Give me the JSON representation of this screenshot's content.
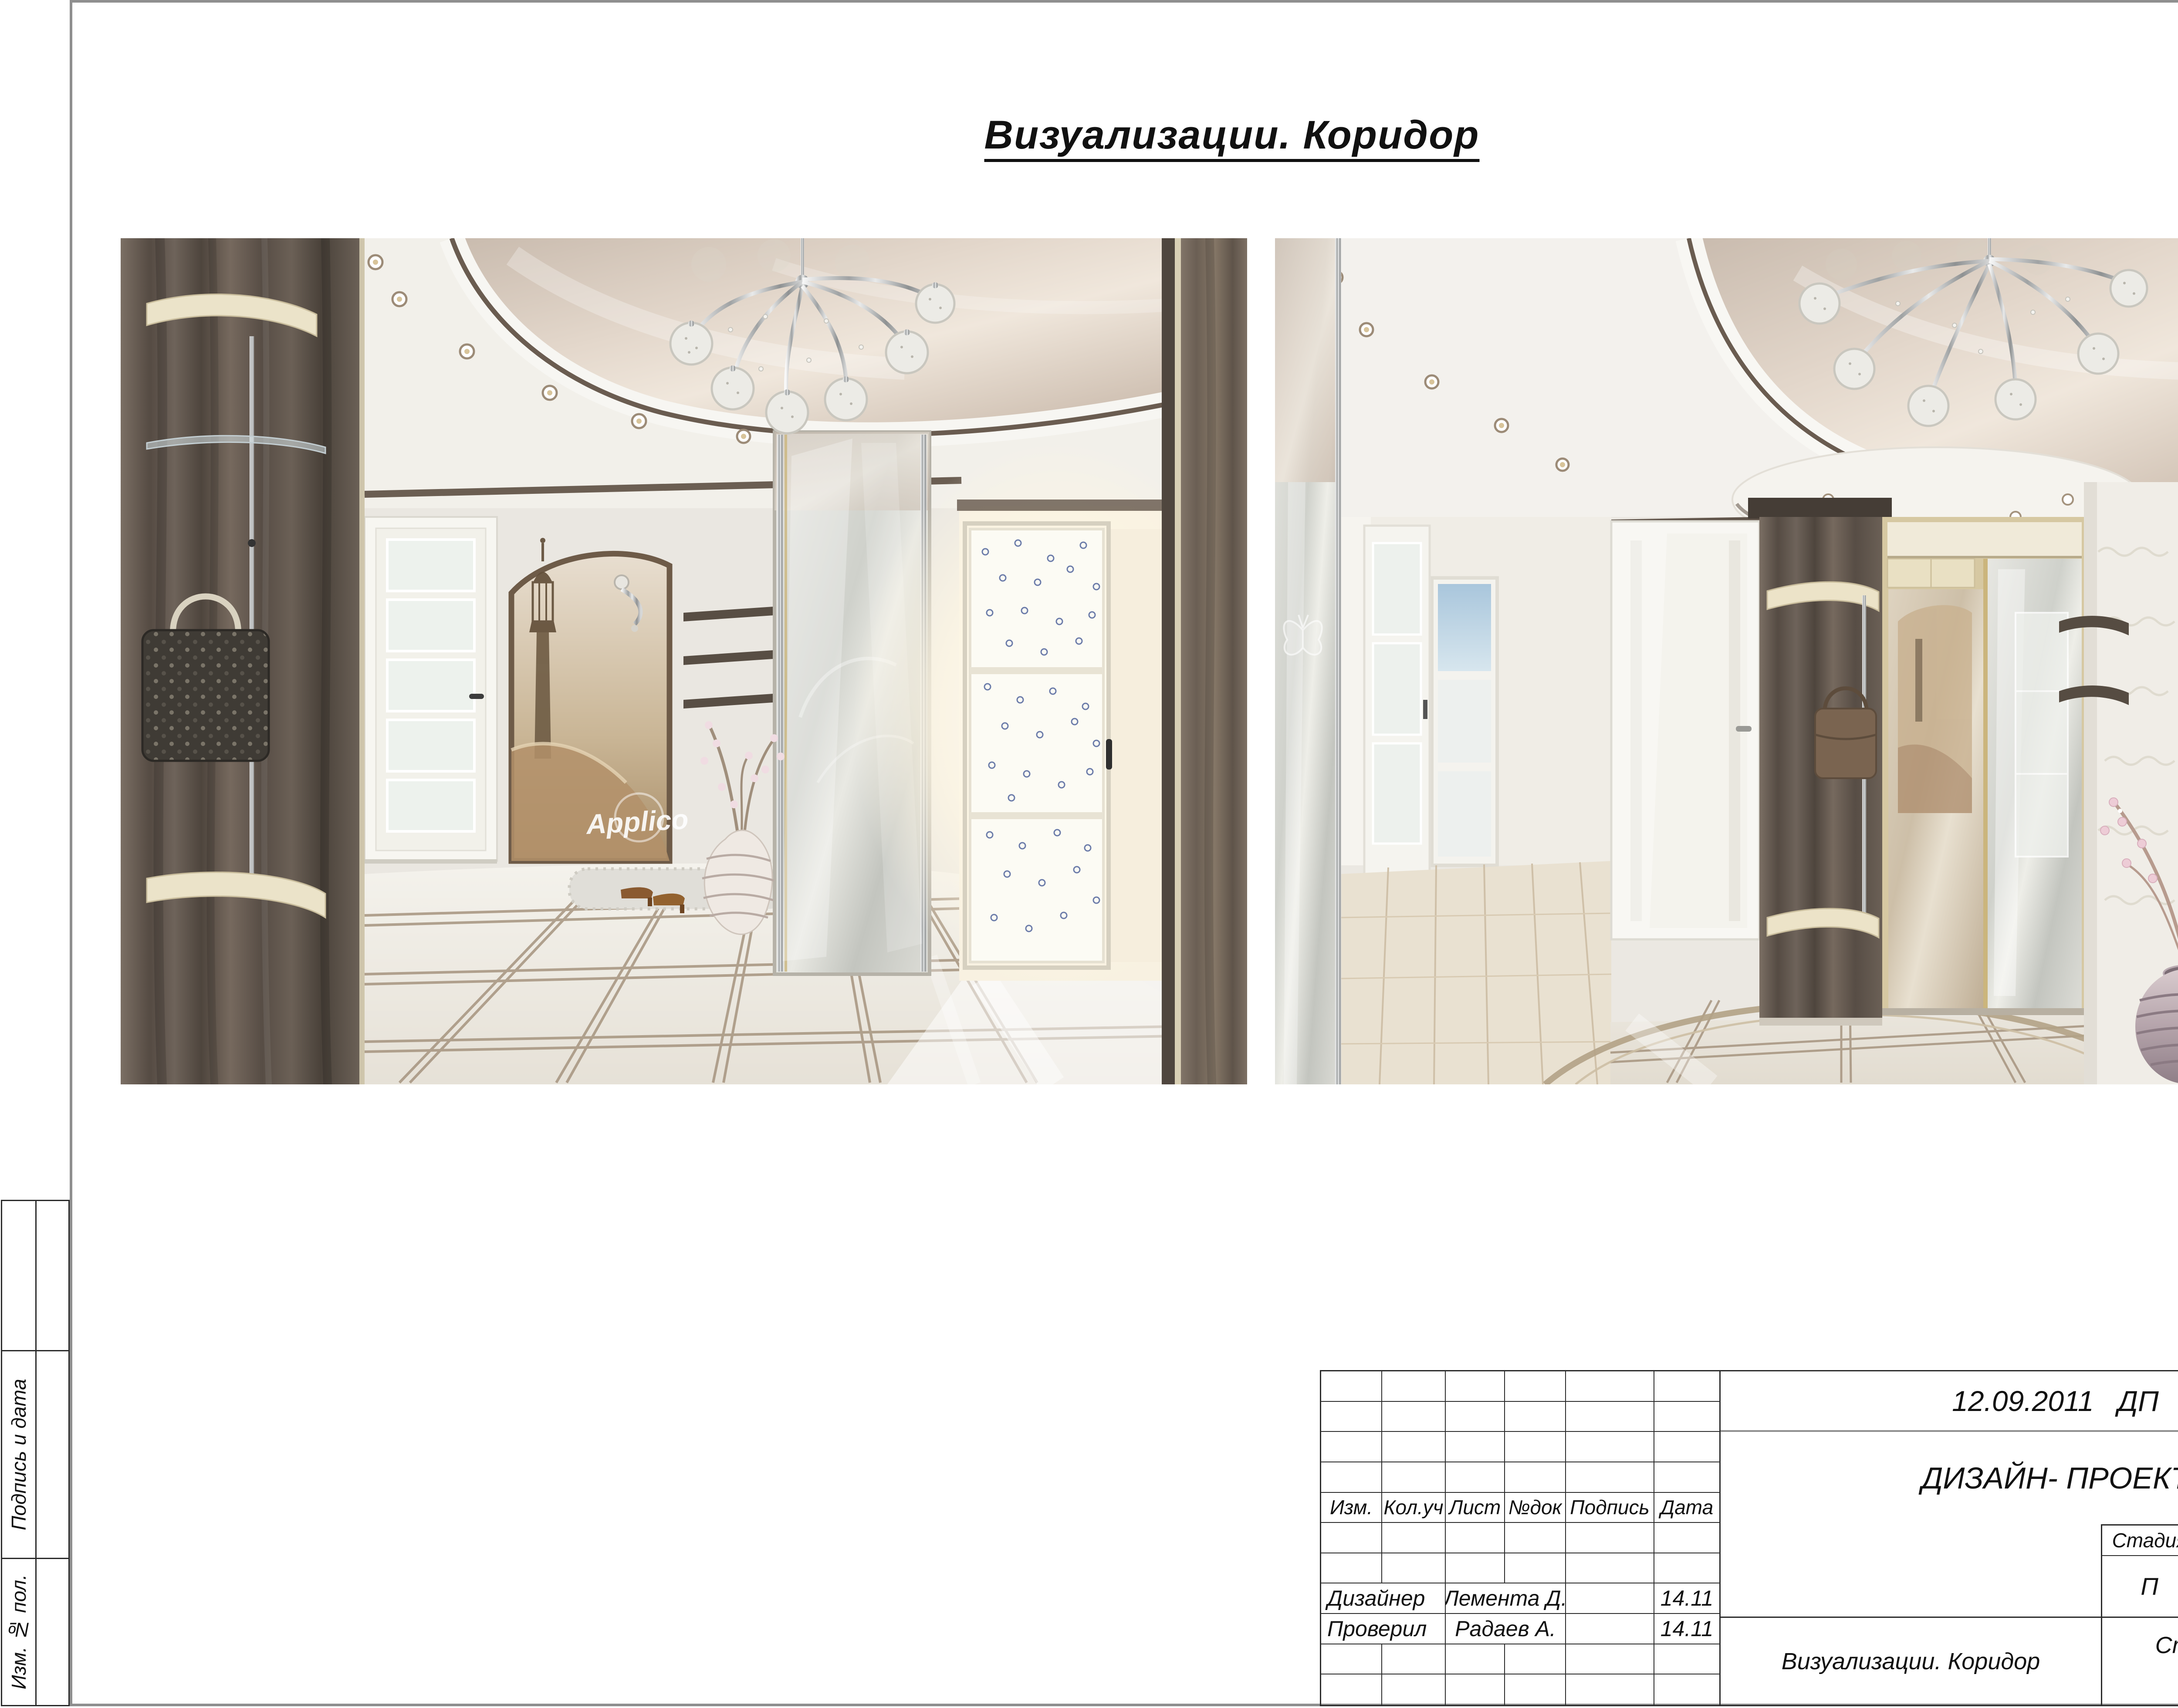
{
  "page": {
    "title": "Визуализации. Коридор"
  },
  "margin": {
    "middle_label": "Подпись и дата",
    "bottom_label": "Изм. № пол."
  },
  "renders": {
    "mural_watermark": "Applico"
  },
  "title_block": {
    "date_stage": "12.09.2011   ДП",
    "doc_type": "ДИЗАЙН- ПРОЕКТ",
    "header": [
      "Изм.",
      "Кол.уч",
      "Лист",
      "№док",
      "Подпись",
      "Дата"
    ],
    "sign_rows": [
      {
        "role": "Дизайнер",
        "name": "Лемента Д.",
        "date": "14.11"
      },
      {
        "role": "Проверил",
        "name": "Радаев А.",
        "date": "14.11"
      }
    ],
    "stage_table": {
      "labels": [
        "Стадия",
        "Лист",
        "Листов"
      ],
      "values": [
        "П",
        "16",
        "26"
      ]
    },
    "sheet_title": "Визуализации. Коридор",
    "studio": [
      "Студия дизайна",
      "“ArtVision”"
    ]
  }
}
